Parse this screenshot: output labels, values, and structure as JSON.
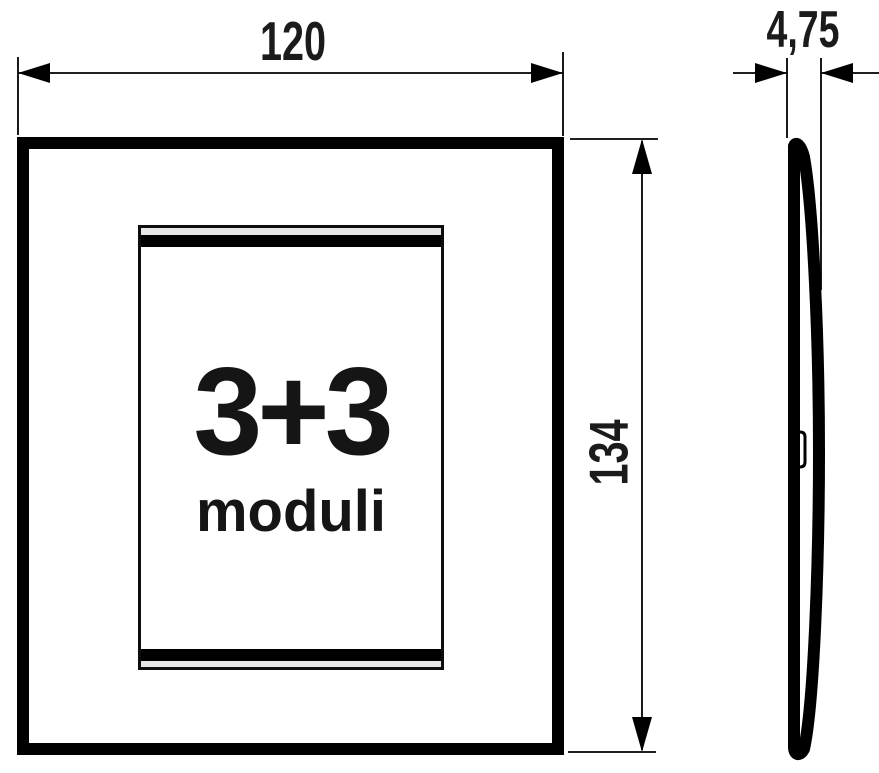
{
  "front_view": {
    "module_count": "3+3",
    "module_label": "moduli"
  },
  "dimensions": {
    "width": "120",
    "height": "134",
    "thickness": "4,75"
  },
  "icons": {
    "arrowheads": "filled-triangle-dimension-arrows"
  },
  "colors": {
    "line": "#000000",
    "text": "#1b1b1b",
    "trim_strip": "#e7e7e7",
    "background": "#ffffff"
  }
}
